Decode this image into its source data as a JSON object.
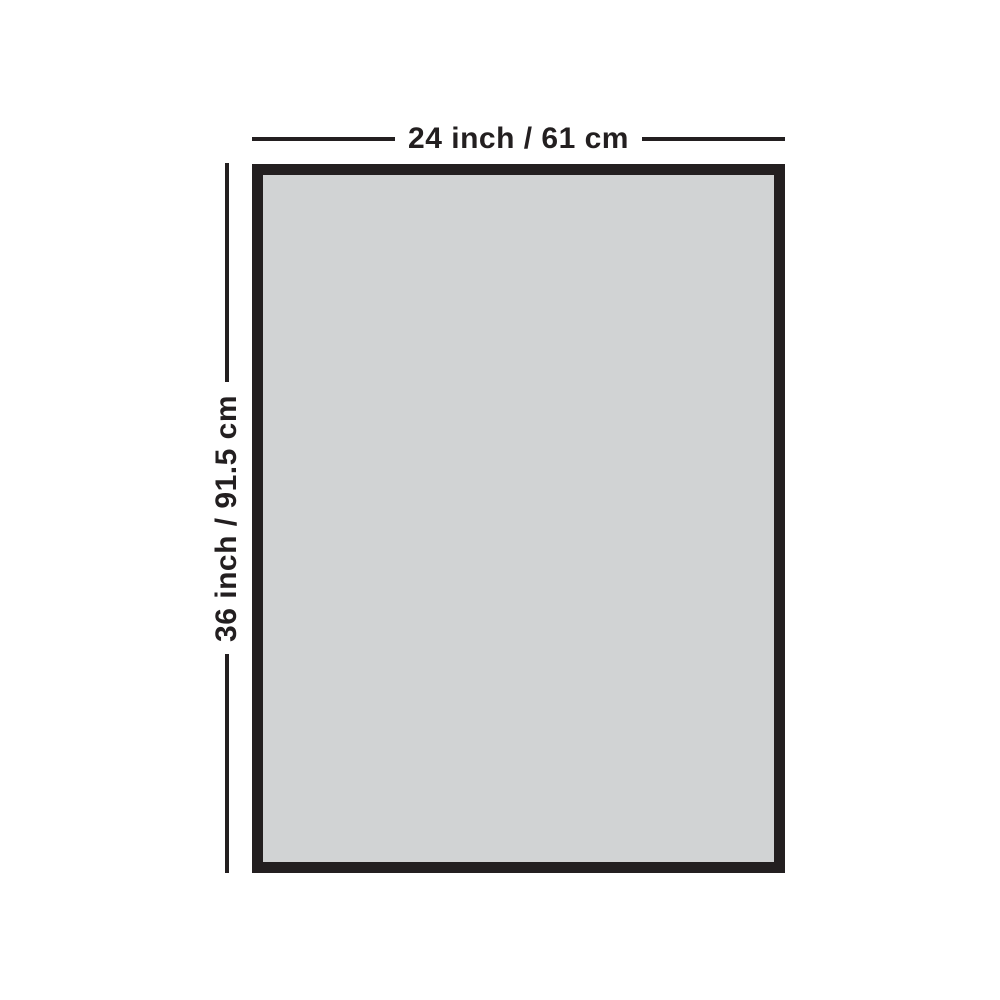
{
  "diagram": {
    "title": "product-dimension-diagram",
    "width_label": "24 inch / 61 cm",
    "height_label": "36 inch / 91.5 cm"
  },
  "colors": {
    "frame": "#231f20",
    "panel_fill": "#d1d3d4",
    "line": "#231f20",
    "text": "#231f20",
    "background": "#ffffff"
  }
}
